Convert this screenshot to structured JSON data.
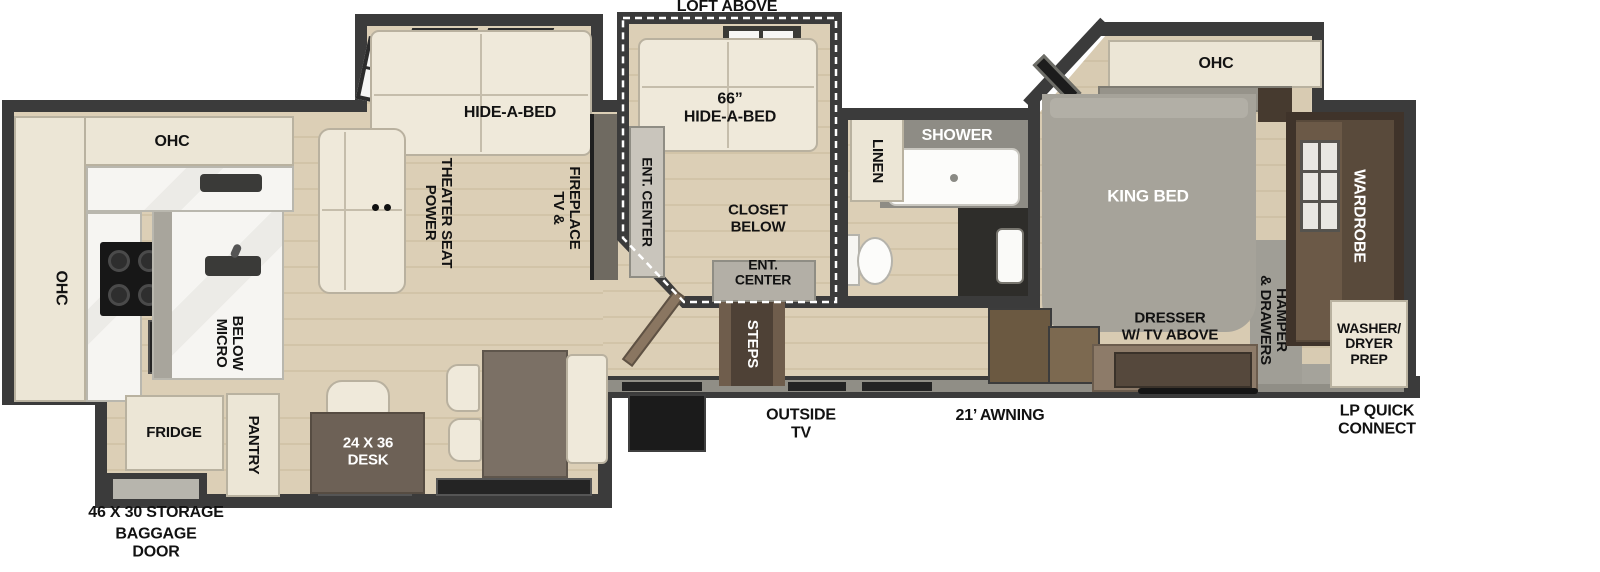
{
  "colors": {
    "wall": "#3b3b3b",
    "floor_wood": "#dccfb6",
    "cabinet_cream": "#ece6d6",
    "counter_marble": "#f4f3f0",
    "sofa_cream": "#efe9da",
    "bed_gray": "#a6a39a",
    "wardrobe_brown": "#3f332a",
    "step_brown": "#4e4136",
    "desk_brown": "#6d6156",
    "label_black": "#121212",
    "label_white": "#ffffff"
  },
  "exterior": {
    "loft_above": "LOFT ABOVE",
    "storage": "46 X 30 STORAGE",
    "baggage_door": "BAGGAGE\nDOOR",
    "outside_tv": "OUTSIDE\nTV",
    "awning": "21’ AWNING",
    "lp_quick_connect": "LP QUICK\nCONNECT"
  },
  "kitchen": {
    "ohc_rear": "OHC",
    "ohc_side": "OHC",
    "micro_below": "MICRO\nBELOW",
    "fridge": "FRIDGE",
    "pantry": "PANTRY"
  },
  "living": {
    "hide_a_bed": "HIDE-A-BED",
    "power_theater_seat": "POWER\nTHEATER SEAT",
    "tv_fireplace": "TV &\nFIREPLACE",
    "desk": "24 X 36\nDESK"
  },
  "loft": {
    "hide_a_bed_66": "66”\nHIDE-A-BED",
    "ent_center_side": "ENT. CENTER",
    "closet_below": "CLOSET\nBELOW",
    "ent_center_bottom": "ENT.\nCENTER",
    "steps": "STEPS"
  },
  "bathroom": {
    "linen": "LINEN",
    "shower": "SHOWER"
  },
  "bedroom": {
    "ohc": "OHC",
    "king_bed": "KING BED",
    "dresser": "DRESSER\nW/ TV ABOVE",
    "hamper_drawers": "HAMPER\n& DRAWERS",
    "wardrobe": "WARDROBE",
    "washer_dryer_prep": "WASHER/\nDRYER\nPREP"
  }
}
